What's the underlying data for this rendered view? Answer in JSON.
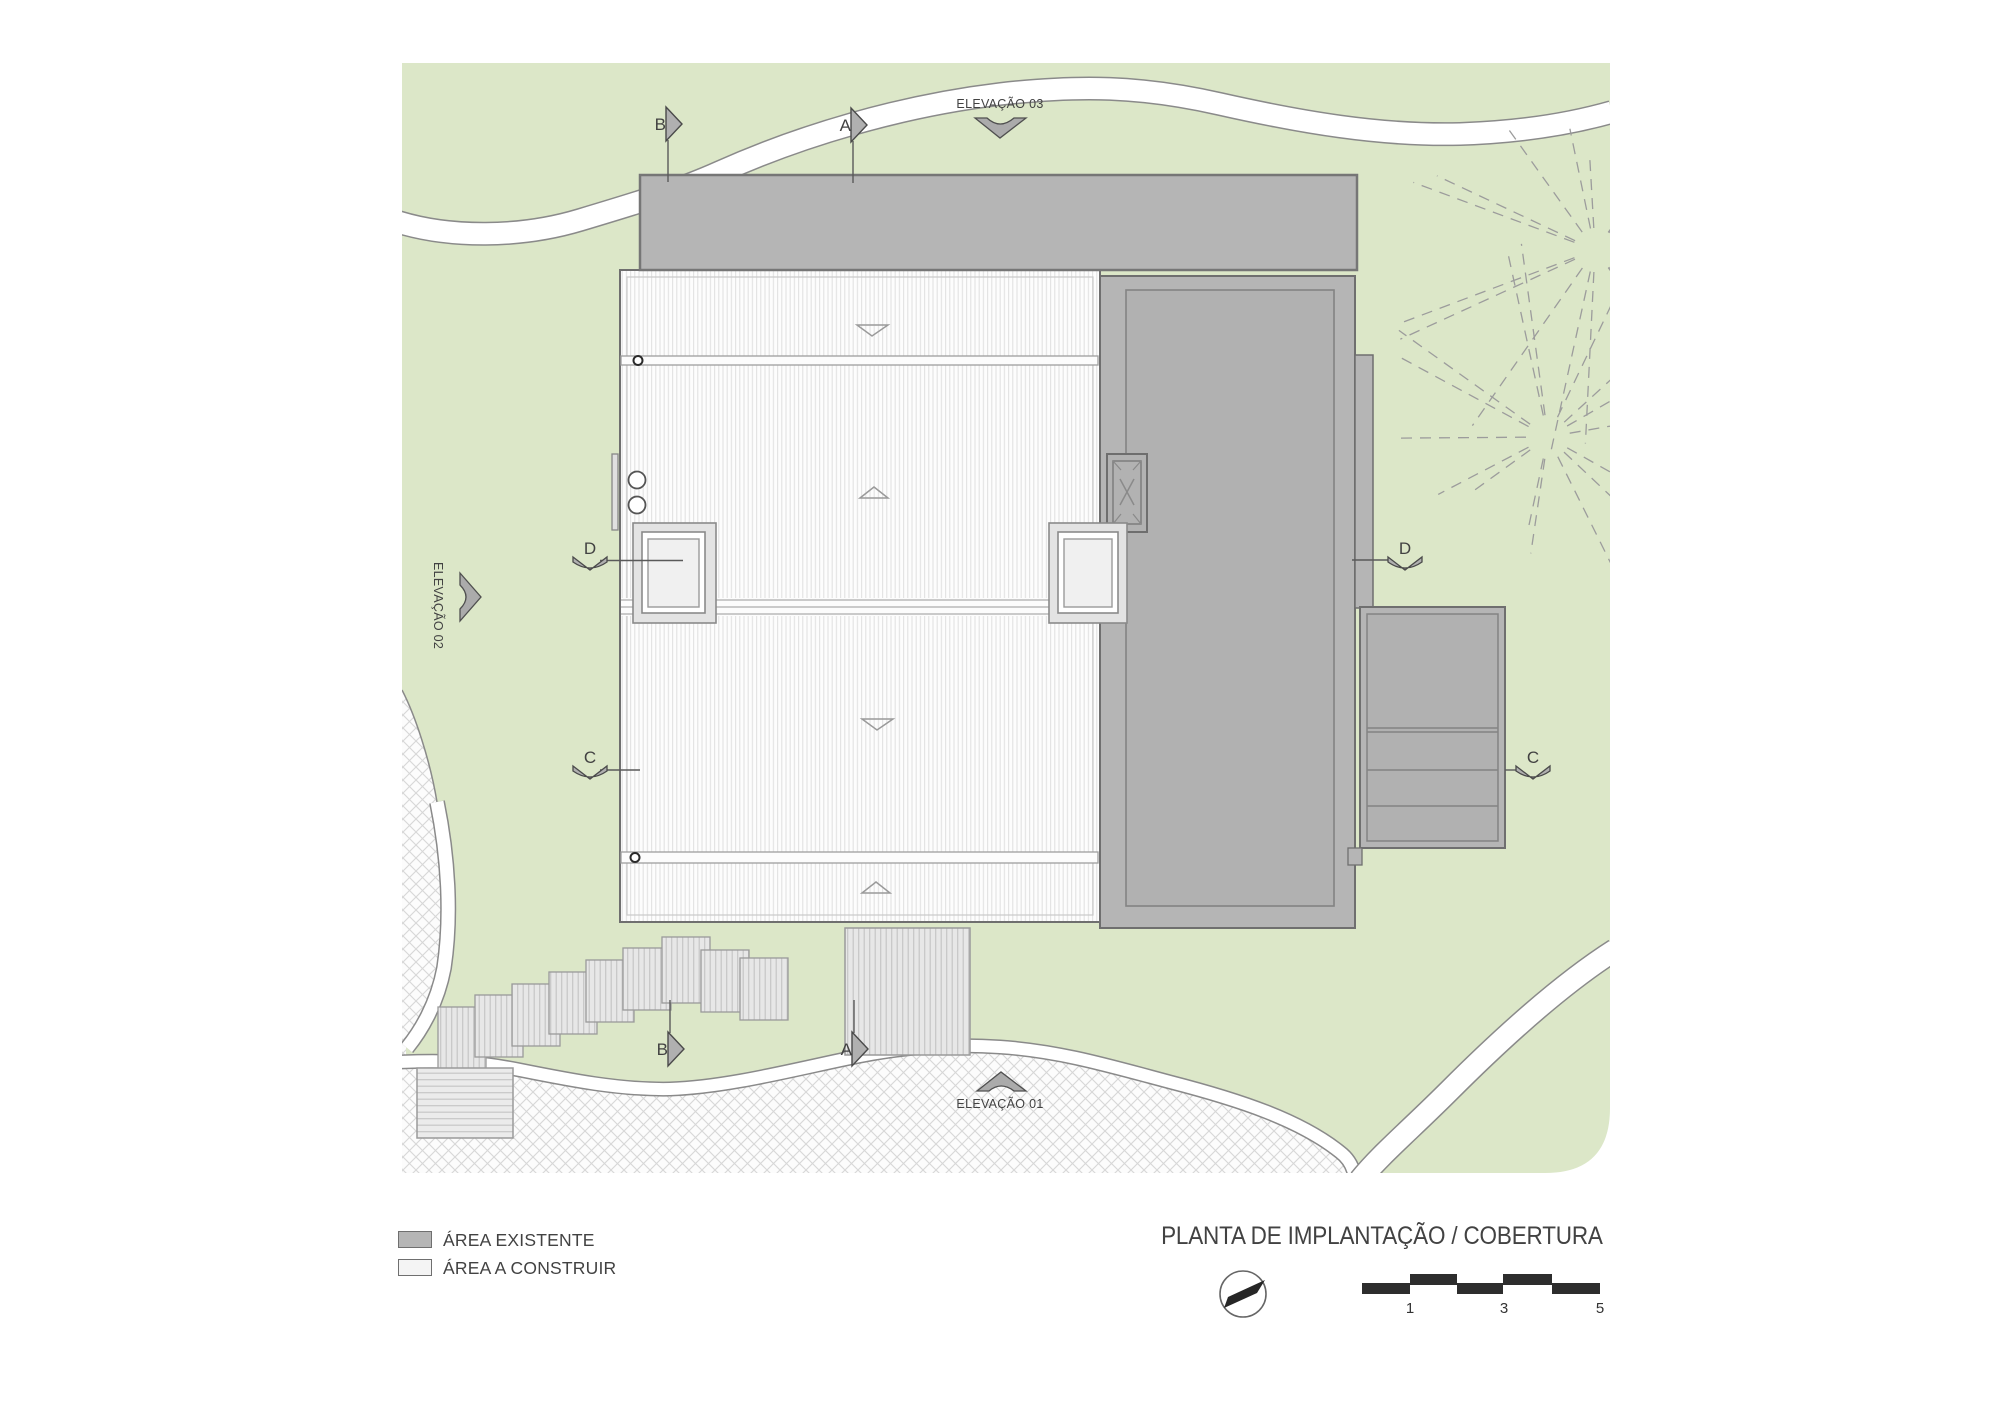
{
  "title": "PLANTA DE IMPLANTAÇÃO / COBERTURA",
  "legend": {
    "existing_label": "ÁREA EXISTENTE",
    "construct_label": "ÁREA A CONSTRUIR"
  },
  "elevation_markers": {
    "e01": "ELEVAÇÃO 01",
    "e02": "ELEVAÇÃO 02",
    "e03": "ELEVAÇÃO 03"
  },
  "section_markers": {
    "top_b": "B",
    "top_a": "A",
    "bottom_b": "B",
    "bottom_a": "A",
    "left_d": "D",
    "left_c": "C",
    "right_d": "D",
    "right_c": "C"
  },
  "scale_bar": {
    "labels": [
      "1",
      "3",
      "5"
    ]
  },
  "colors": {
    "site_green": "#dce7c8",
    "existing_gray": "#b5b5b5",
    "existing_gray_inner": "#b1b1b1",
    "construct_white": "#fdfdfd",
    "outline_dark": "#6f6f6f",
    "path_edge": "#8a8a8a",
    "text_gray": "#424242",
    "scalebar_black": "#2d2d2d"
  }
}
